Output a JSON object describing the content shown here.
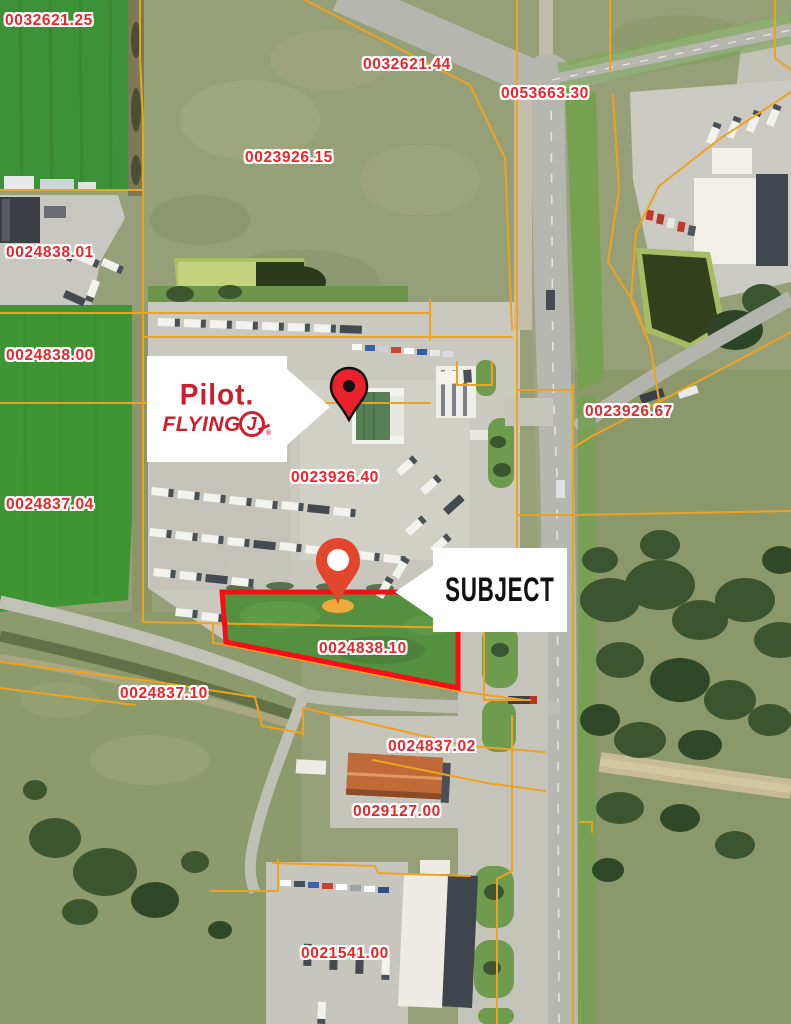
{
  "map": {
    "parcel_labels": [
      {
        "id": "0032621.25"
      },
      {
        "id": "0032621.44"
      },
      {
        "id": "0053663.30"
      },
      {
        "id": "0023926.15"
      },
      {
        "id": "0024838.01"
      },
      {
        "id": "0024838.00"
      },
      {
        "id": "0023926.67"
      },
      {
        "id": "0024837.04"
      },
      {
        "id": "0023926.40"
      },
      {
        "id": "0024838.10"
      },
      {
        "id": "0024837.10"
      },
      {
        "id": "0024837.02"
      },
      {
        "id": "0029127.00"
      },
      {
        "id": "0021541.00"
      }
    ],
    "subject": {
      "callout_label": "SUBJECT",
      "parcel_id": "0024838.10"
    },
    "pilot": {
      "wordmark_line1": "Pilot",
      "wordmark_period": ".",
      "wordmark_line2": "FLYING",
      "wordmark_j": "J",
      "registered_mark": "®"
    }
  },
  "colors": {
    "parcel_line_orange": "#F0A21E",
    "parcel_label_red": "#E8262B",
    "subject_outline_red": "#FB0D17",
    "pilot_brand_red": "#CE1E2D",
    "pin_red": "#EA222C",
    "subject_pin_red": "#E2472E",
    "subject_pin_base_gold": "#F0A93C",
    "callout_background": "#FFFFFF"
  }
}
